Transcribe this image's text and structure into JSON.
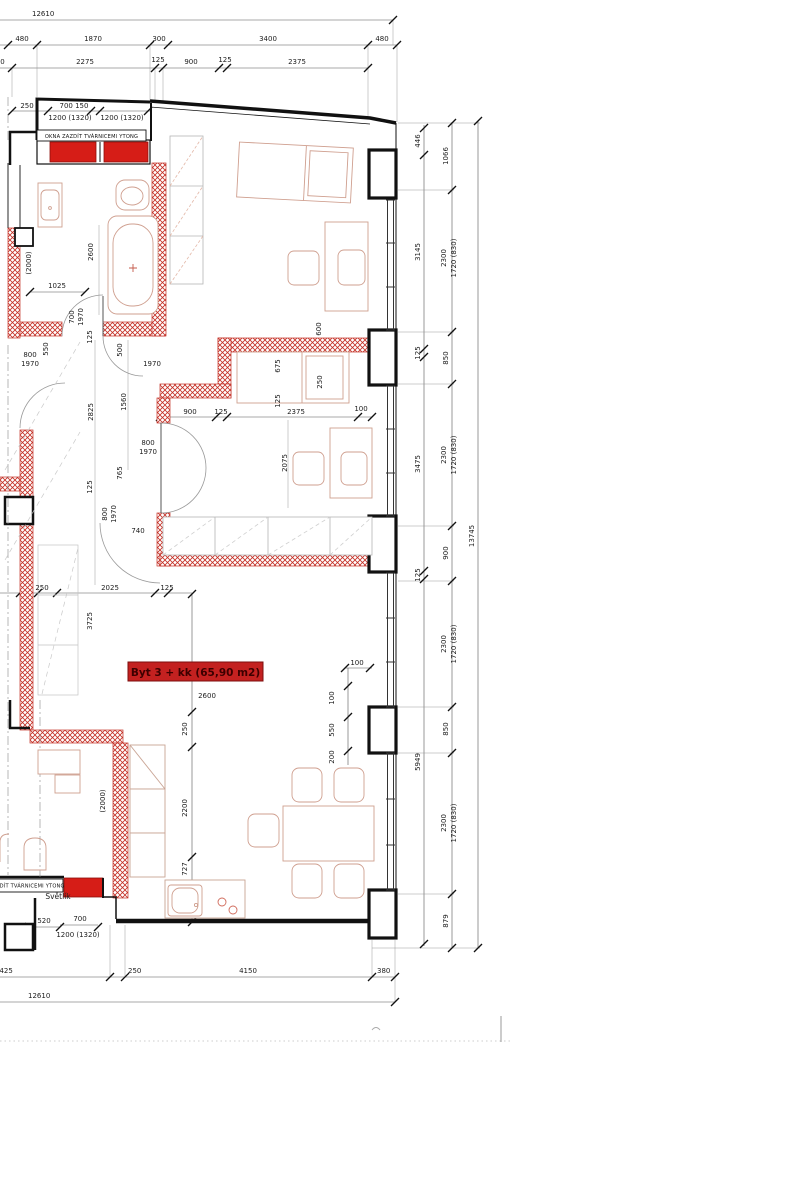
{
  "drawing": {
    "title_label": "Byt 3 + kk (65,90 m2)",
    "notes": {
      "okna_top": "OKNA ZAZDÍT TVÁRNICEMI YTONG",
      "okna_bottom": "OKNA ZAZDÍT TVÁRNICEMI YTONG",
      "svetlik": "Světlík"
    },
    "colors": {
      "wall_accent": "#c43026",
      "brick_fill": "#d61d17",
      "label_bg": "#c32120",
      "label_text": "#3d0000"
    },
    "dims": {
      "top_total": "12610",
      "top_row2": [
        "480",
        "1870",
        "300",
        "3400",
        "480"
      ],
      "top_row3": [
        "250",
        "2275",
        "125",
        "900",
        "125",
        "2375"
      ],
      "win_top": [
        "250",
        "700 150",
        "1200  (1320)",
        "1200  (1320)"
      ],
      "right_col1": [
        "446",
        "3145",
        "125",
        "3475",
        "125",
        "5949"
      ],
      "right_col2": [
        "1066",
        "2300",
        "1720  (830)",
        "850",
        "2300",
        "1720  (830)",
        "900",
        "2300",
        "1720  (830)",
        "850",
        "2300",
        "1720  (830)",
        "879"
      ],
      "right_total": "13745",
      "bottom_row": [
        "3425",
        "250",
        "4150",
        "380"
      ],
      "bottom_total": "12610",
      "bath": [
        "(2000)",
        "2600",
        "1025",
        "700",
        "1970",
        "125",
        "550",
        "800",
        "1970",
        "500",
        "1970"
      ],
      "corridor": [
        "2825",
        "1560",
        "800",
        "1970",
        "765",
        "125",
        "800",
        "1970",
        "740"
      ],
      "bedroom2": [
        "600",
        "675",
        "250",
        "125",
        "900",
        "125",
        "2375",
        "100",
        "2075"
      ],
      "living": [
        "250",
        "2025",
        "125",
        "3725",
        "2600",
        "250",
        "2200",
        "727",
        "100",
        "100",
        "550",
        "200"
      ],
      "svetlik": [
        "520",
        "700",
        "1200  (1320)"
      ],
      "left_flat": [
        "(2000)"
      ]
    }
  }
}
